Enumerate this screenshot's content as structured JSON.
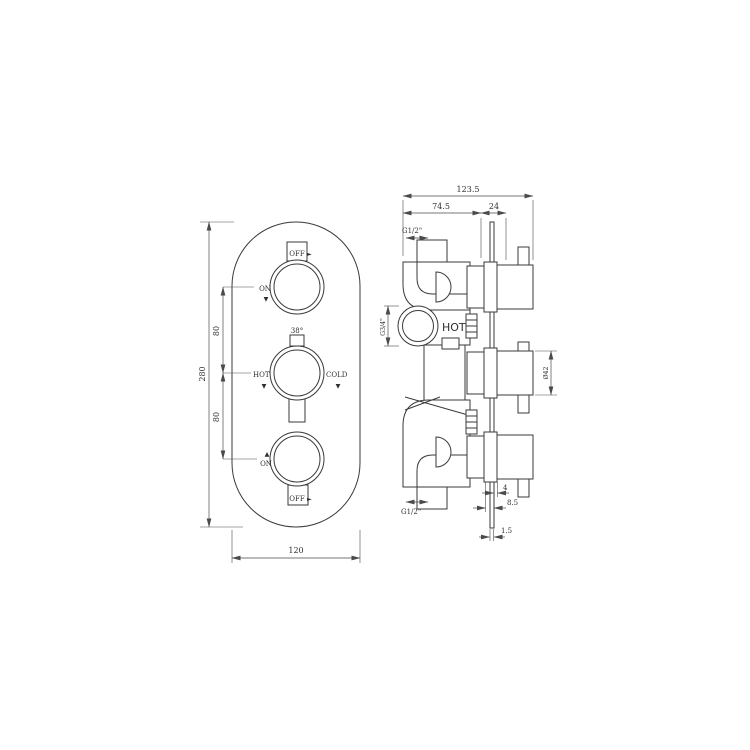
{
  "front": {
    "dim_height": "280",
    "dim_gap_upper": "80",
    "dim_gap_lower": "80",
    "dim_width": "120",
    "top_stem_label": "OFF",
    "top_on_label": "ON",
    "temp_label": "38°",
    "hot_label": "HOT",
    "cold_label": "COLD",
    "bottom_on_label": "ON",
    "bottom_stem_label": "OFF",
    "arrow_right": "►",
    "arrow_down": "▼",
    "arrow_up": "▲"
  },
  "side": {
    "dim_overall": "123.5",
    "dim_rough_in": "74.5",
    "dim_trim": "24",
    "dim_handle_diameter": "Ø42",
    "dim_flange_depth": "4",
    "dim_plate_to_body": "8.5",
    "dim_plate_thickness": "1.5",
    "hot_inlet_label": "HOT",
    "top_port_label": "G1/2\"",
    "bottom_port_label": "G1/2\"",
    "inlet_thread_label": "G3/4\""
  },
  "colors": {
    "line_color": "#3a3a3a",
    "background": "#ffffff"
  }
}
